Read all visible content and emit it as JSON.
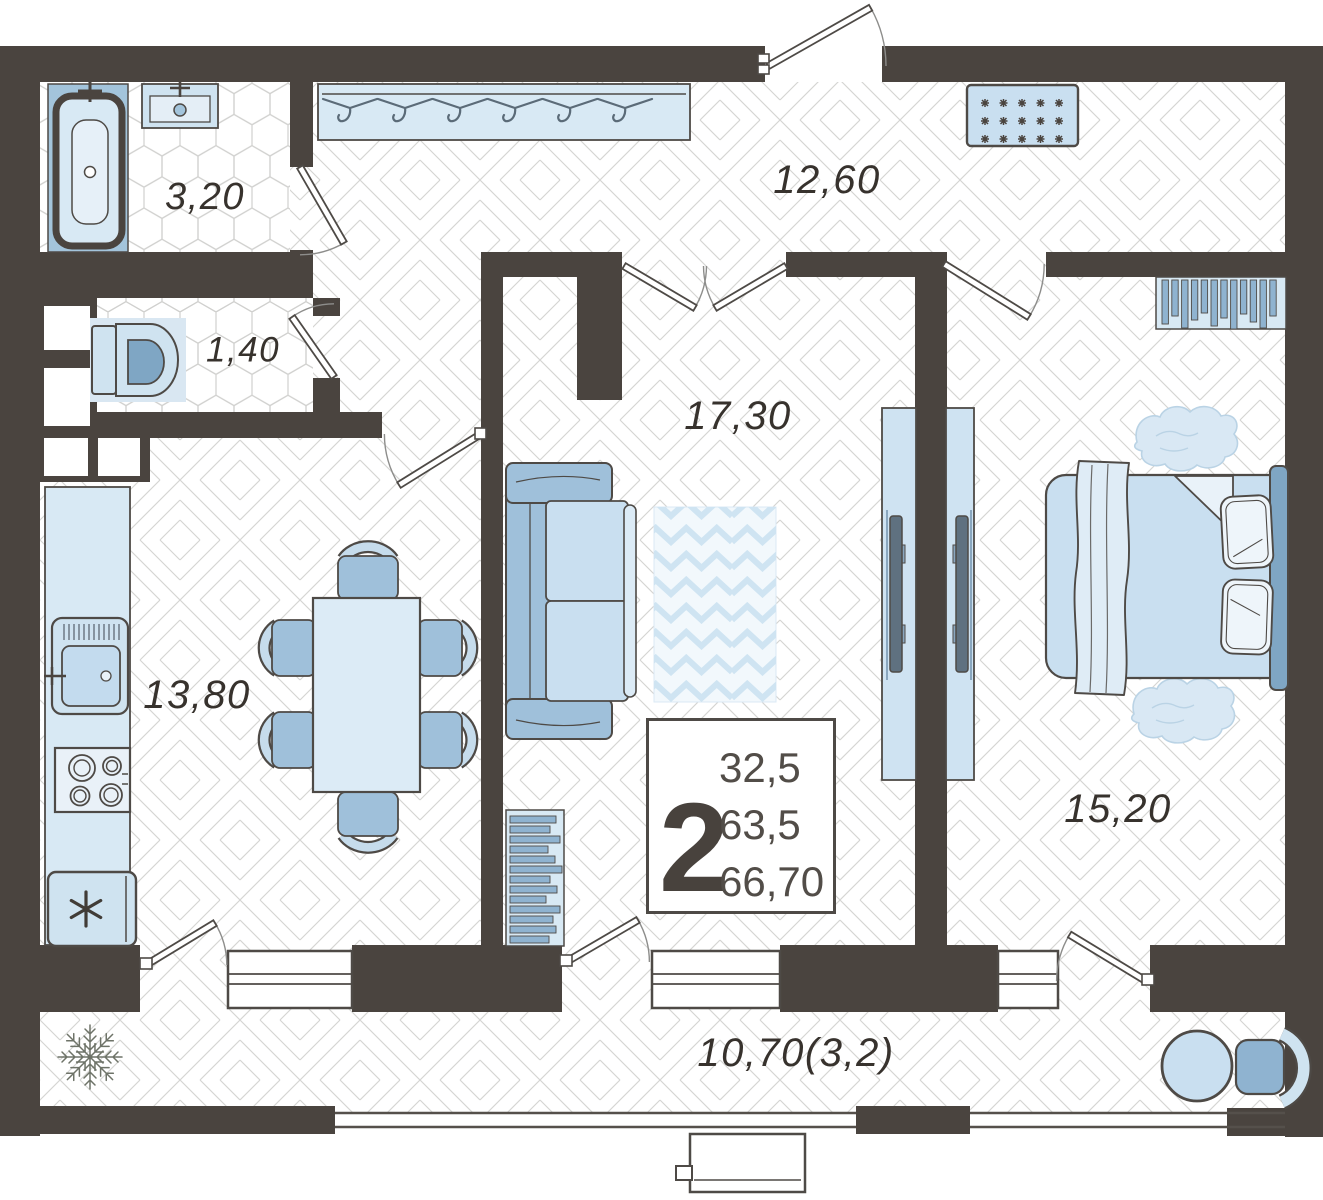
{
  "plan": {
    "info_box": {
      "number": "2",
      "lines": [
        "32,5",
        "63,5",
        "66,70"
      ]
    },
    "room_labels": {
      "bathroom": "3,20",
      "wc": "1,40",
      "hallway": "12,60",
      "living_room": "17,30",
      "kitchen": "13,80",
      "bedroom": "15,20",
      "balcony": "10,70(3,2)"
    },
    "palette": {
      "wall": "#4a443f",
      "floor_line": "#d5d5d3",
      "fixture_light": "#d8e9f4",
      "fixture_mid": "#9fc0da",
      "fixture_dark": "#7fa6c4",
      "text": "#37322d"
    }
  }
}
